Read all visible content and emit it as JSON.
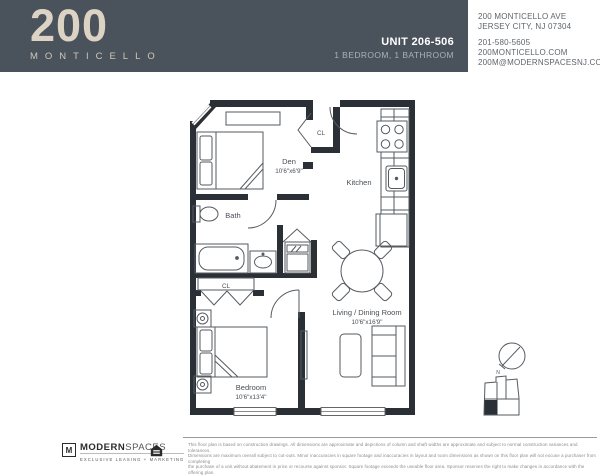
{
  "header": {
    "logo": {
      "number": "200",
      "name": "MONTICELLO"
    },
    "unit": {
      "title": "UNIT 206-506",
      "subtitle": "1 BEDROOM,  1 BATHROOM"
    },
    "contact": {
      "address_line1": "200 MONTICELLO AVE",
      "address_line2": "JERSEY CITY, NJ 07304",
      "phone": "201-580-5605",
      "website": "200MONTICELLO.COM",
      "email": "200M@MODERNSPACESNJ.COM"
    },
    "colors": {
      "background": "#4a525b",
      "logo": "#dcd3c4",
      "subtitle": "#a9b0b7"
    }
  },
  "floorplan": {
    "wall_color": "#2b3036",
    "line_color": "#565b61",
    "labels": {
      "den_name": "Den",
      "den_dim": "10'6\"x6'9\"",
      "kitchen": "Kitchen",
      "bath": "Bath",
      "closet_entry": "CL",
      "closet_bedroom": "CL",
      "living_name": "Living / Dining Room",
      "living_dim": "10'6\"x16'9\"",
      "bedroom_name": "Bedroom",
      "bedroom_dim": "10'6\"x13'4\""
    },
    "compass_label": "N"
  },
  "footer": {
    "brand": {
      "initial": "M",
      "name_bold": "MODERN",
      "name_light": "SPACES",
      "tagline": "EXCLUSIVE LEASING + MARKETING"
    },
    "disclaimer_lines": [
      "This floor plan is based on construction drawings. All dimensions are approximate and depictions of column and shaft widths are approximate and subject to normal construction variances and tolerances.",
      "Dimensions are maximum overall subject to cut-outs. Minor inaccuracies in square footage and inaccuracies in layout and room dimensions as shown on this floor plan will not excuse a purchaser from completing",
      "the purchase of a unit without abatement in price or recourse against sponsor. Square footage exceeds the useable floor area. Sponsor reserves the right to make changes in accordance with the offering plan."
    ]
  }
}
